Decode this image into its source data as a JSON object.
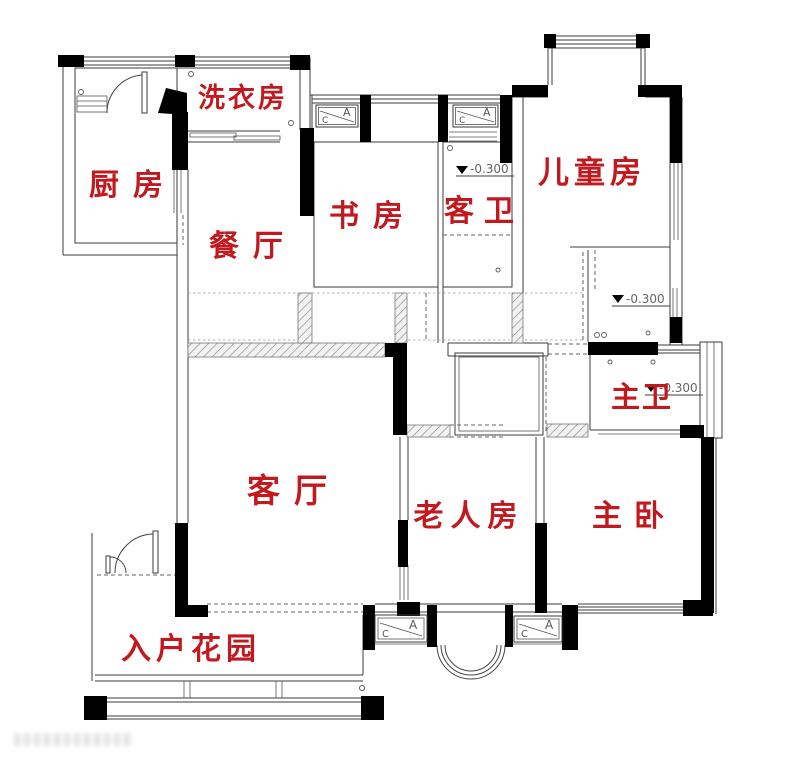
{
  "floorplan": {
    "rooms": {
      "laundry": {
        "label": "洗衣房"
      },
      "kitchen": {
        "label": "厨房"
      },
      "dining": {
        "label": "餐厅"
      },
      "study": {
        "label": "书房"
      },
      "guest_bath": {
        "label": "客卫"
      },
      "kids_room": {
        "label": "儿童房"
      },
      "master_bath": {
        "label": "主卫"
      },
      "living": {
        "label": "客厅"
      },
      "elder_room": {
        "label": "老人房"
      },
      "master_bedroom": {
        "label": "主卧"
      },
      "entry_garden": {
        "label": "入户花园"
      }
    },
    "elevation_markers": [
      {
        "location": "guest-bath",
        "value": "-0.300"
      },
      {
        "location": "closet-area",
        "value": "-0.300"
      },
      {
        "location": "master-bath",
        "value": "-0.300"
      }
    ],
    "window_tags": [
      {
        "location": "study-bay",
        "c": "C",
        "a": "A"
      },
      {
        "location": "guest-bath-bay",
        "c": "C",
        "a": "A"
      },
      {
        "location": "south-bay-left",
        "c": "C",
        "a": "A"
      },
      {
        "location": "south-bay-right",
        "c": "C",
        "a": "A"
      }
    ],
    "colors": {
      "room_label": "#c2191f",
      "wall": "#000000",
      "line": "#3b3b3b"
    }
  }
}
